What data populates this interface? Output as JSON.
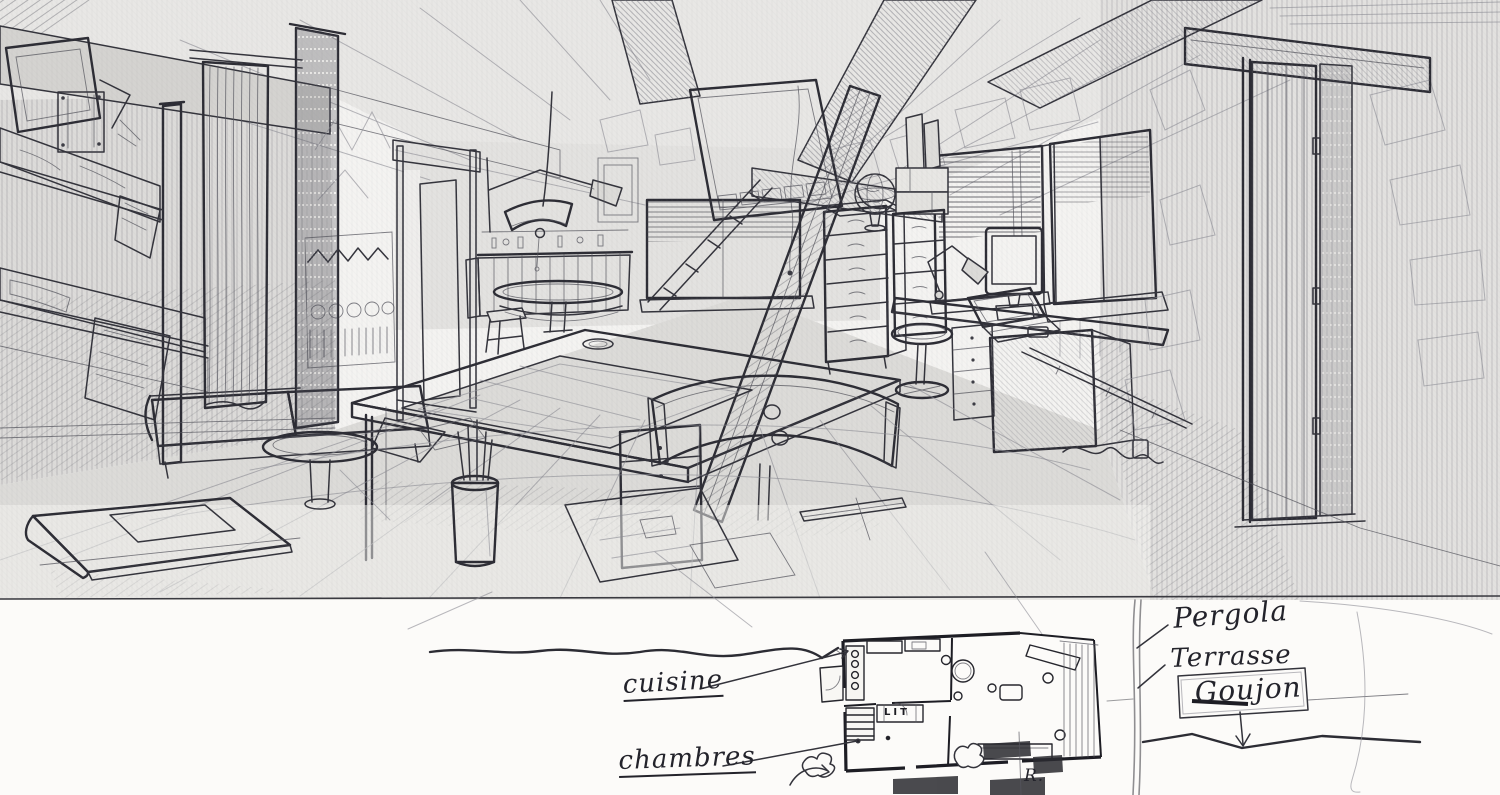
{
  "scene": {
    "medium": "pencil sketch",
    "subject": "chalet studio interior perspective with annotated floor plan"
  },
  "annotations": {
    "pergola": "Pergola",
    "terrasse": "Terrasse",
    "signature": "Goujon",
    "cuisine": "cuisine",
    "chambres": "chambres",
    "bed": "LIT",
    "corner_note": "R."
  },
  "plan": {
    "rooms": [
      "cuisine",
      "chambres"
    ],
    "outdoor": [
      "Pergola",
      "Terrasse"
    ],
    "bed_label": "LIT"
  },
  "colors": {
    "paper": "#f4f3f1",
    "strip": "#fcfbf9",
    "graphite": "#2e2e35",
    "graphite_light": "#8a8a92",
    "window_white": "#fcfcfa"
  }
}
